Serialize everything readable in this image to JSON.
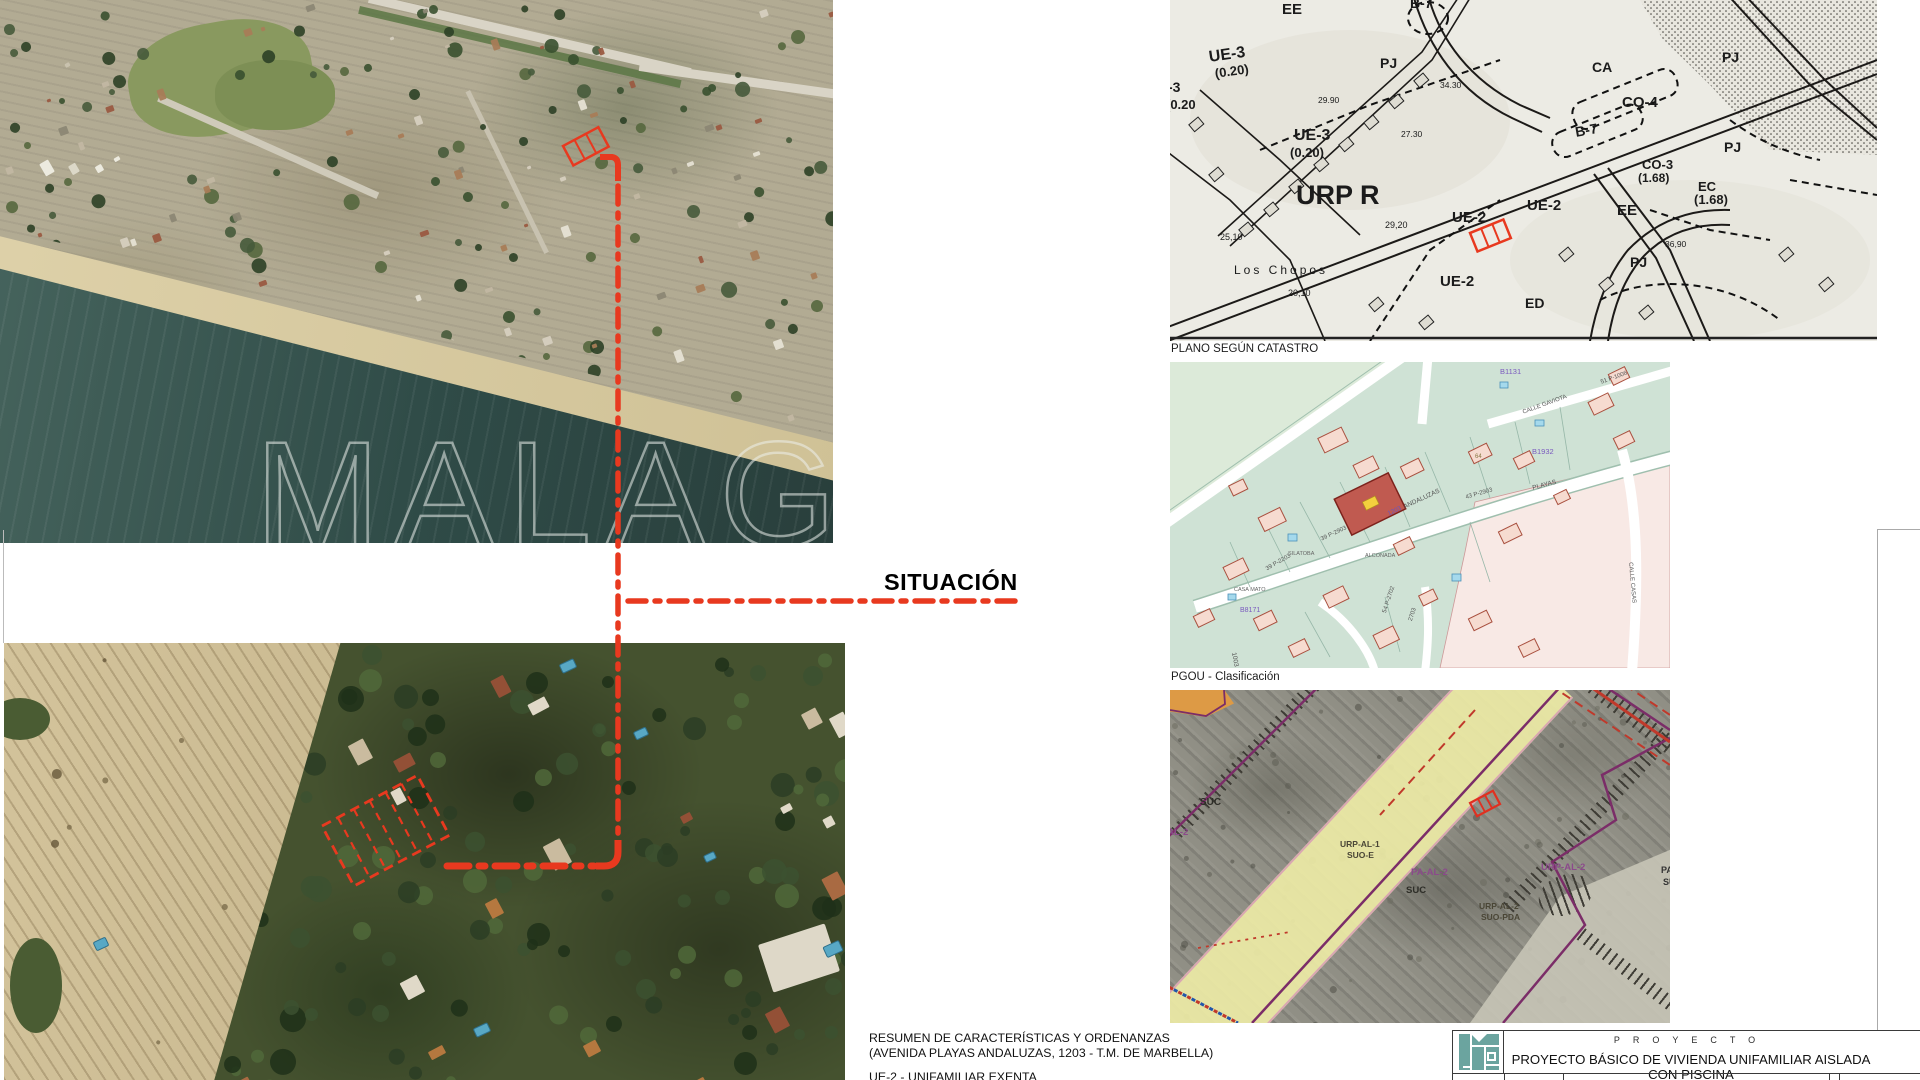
{
  "colors": {
    "accent_red": "#e8391f",
    "logo_teal": "#6ba49f"
  },
  "situacion_label": "SITUACIÓN",
  "watermark_text": "MALAGA",
  "captions": {
    "catastro": "PLANO SEGÚN CATASTRO",
    "pgou": "PGOU - Clasificación"
  },
  "summary": {
    "line1": "RESUMEN DE CARACTERÍSTICAS Y ORDENANZAS",
    "line2": "(AVENIDA PLAYAS ANDALUZAS, 1203 - T.M. DE MARBELLA)",
    "line3": "UE-2 - UNIFAMILIAR EXENTA"
  },
  "title_block": {
    "kicker": "PROYECTO",
    "title": "PROYECTO BÁSICO DE VIVIENDA UNIFAMILIAR AISLADA CON PISCINA"
  },
  "bw_map": {
    "labels": [
      {
        "t": "EE",
        "x": 112,
        "y": 2,
        "fs": 15,
        "b": 1
      },
      {
        "t": "B-7",
        "x": 240,
        "y": -4,
        "fs": 14,
        "b": 1
      },
      {
        "t": "PJ",
        "x": 210,
        "y": 56,
        "fs": 14,
        "b": 1
      },
      {
        "t": "UE-3",
        "x": 38,
        "y": 50,
        "fs": 16,
        "b": 1,
        "r": -8
      },
      {
        "t": "(0.20)",
        "x": 44,
        "y": 67,
        "fs": 13,
        "b": 1,
        "r": -8
      },
      {
        "t": "-3",
        "x": -2,
        "y": 80,
        "fs": 14,
        "b": 1
      },
      {
        "t": "(0.20",
        "x": -4,
        "y": 98,
        "fs": 13,
        "b": 1
      },
      {
        "t": "UE-3",
        "x": 124,
        "y": 128,
        "fs": 16,
        "b": 1
      },
      {
        "t": "(0.20)",
        "x": 120,
        "y": 146,
        "fs": 13,
        "b": 1
      },
      {
        "t": "29.90",
        "x": 148,
        "y": 96,
        "fs": 8.5
      },
      {
        "t": "34.30",
        "x": 270,
        "y": 81,
        "fs": 8.5
      },
      {
        "t": "27.30",
        "x": 231,
        "y": 130,
        "fs": 8.5
      },
      {
        "t": "URP R",
        "x": 126,
        "y": 182,
        "fs": 27,
        "b": 1
      },
      {
        "t": "25,10",
        "x": 50,
        "y": 233,
        "fs": 9
      },
      {
        "t": "29,20",
        "x": 215,
        "y": 221,
        "fs": 9
      },
      {
        "t": "Los Chopos",
        "x": 64,
        "y": 264,
        "fs": 12,
        "ls": 3
      },
      {
        "t": "20,10",
        "x": 118,
        "y": 289,
        "fs": 9
      },
      {
        "t": "UE-2",
        "x": 282,
        "y": 210,
        "fs": 15,
        "b": 1
      },
      {
        "t": "UE-2",
        "x": 357,
        "y": 198,
        "fs": 15,
        "b": 1
      },
      {
        "t": "UE-2",
        "x": 270,
        "y": 274,
        "fs": 15,
        "b": 1
      },
      {
        "t": "ED",
        "x": 355,
        "y": 296,
        "fs": 14,
        "b": 1
      },
      {
        "t": "CA",
        "x": 422,
        "y": 60,
        "fs": 14,
        "b": 1
      },
      {
        "t": "CO-4",
        "x": 452,
        "y": 95,
        "fs": 15,
        "b": 1
      },
      {
        "t": "B-7",
        "x": 404,
        "y": 125,
        "fs": 14,
        "b": 1,
        "r": -10
      },
      {
        "t": "PJ",
        "x": 552,
        "y": 50,
        "fs": 14,
        "b": 1
      },
      {
        "t": "PJ",
        "x": 554,
        "y": 140,
        "fs": 14,
        "b": 1
      },
      {
        "t": "CO-3",
        "x": 472,
        "y": 158,
        "fs": 13,
        "b": 1
      },
      {
        "t": "(1.68)",
        "x": 468,
        "y": 172,
        "fs": 12,
        "b": 1
      },
      {
        "t": "EC",
        "x": 528,
        "y": 180,
        "fs": 13,
        "b": 1
      },
      {
        "t": "(1.68)",
        "x": 524,
        "y": 193,
        "fs": 13,
        "b": 1
      },
      {
        "t": "EE",
        "x": 447,
        "y": 203,
        "fs": 15,
        "b": 1
      },
      {
        "t": "PJ",
        "x": 460,
        "y": 255,
        "fs": 14,
        "b": 1
      },
      {
        "t": "36,90",
        "x": 495,
        "y": 240,
        "fs": 8.5
      }
    ]
  },
  "parcel_map": {
    "labels": [
      {
        "t": "B1131",
        "x": 330,
        "y": 6,
        "fs": 7.5,
        "c": "#7a5abf"
      },
      {
        "t": "B1932",
        "x": 362,
        "y": 86,
        "fs": 7.5,
        "c": "#7a5abf"
      },
      {
        "t": "B8171",
        "x": 70,
        "y": 245,
        "fs": 7,
        "c": "#7a5abf"
      },
      {
        "t": "CALLE GAVIOTA",
        "x": 352,
        "y": 48,
        "fs": 6,
        "r": -20,
        "c": "#555"
      },
      {
        "t": "PLAYAS",
        "x": 362,
        "y": 124,
        "fs": 6.5,
        "r": -15,
        "c": "#555"
      },
      {
        "t": "43 P-2903",
        "x": 295,
        "y": 133,
        "fs": 6,
        "r": -16,
        "c": "#555"
      },
      {
        "t": "1203",
        "x": 217,
        "y": 150,
        "fs": 6.5,
        "r": -25,
        "c": "#6a55c0"
      },
      {
        "t": "ANDALUZAS",
        "x": 233,
        "y": 143,
        "fs": 6.5,
        "r": -25,
        "c": "#555"
      },
      {
        "t": "39 P-2903",
        "x": 150,
        "y": 175,
        "fs": 6,
        "r": -25,
        "c": "#555"
      },
      {
        "t": "39 P-2203",
        "x": 95,
        "y": 205,
        "fs": 6,
        "r": -30,
        "c": "#555"
      },
      {
        "t": "SILATOBA",
        "x": 118,
        "y": 190,
        "fs": 5.5,
        "c": "#666"
      },
      {
        "t": "ALCONADA",
        "x": 195,
        "y": 192,
        "fs": 5.5,
        "c": "#666"
      },
      {
        "t": "CASA MATO",
        "x": 64,
        "y": 226,
        "fs": 5.5,
        "c": "#666"
      },
      {
        "t": "64",
        "x": 305,
        "y": 92,
        "fs": 6,
        "c": "#887744"
      },
      {
        "t": "CALLE CASAS",
        "x": 463,
        "y": 200,
        "fs": 6,
        "r": 85,
        "c": "#555"
      },
      {
        "t": "54 P-2702",
        "x": 212,
        "y": 250,
        "fs": 6,
        "r": -72,
        "c": "#555"
      },
      {
        "t": "2703",
        "x": 238,
        "y": 258,
        "fs": 6,
        "r": -72,
        "c": "#555"
      },
      {
        "t": "1003",
        "x": 66,
        "y": 290,
        "fs": 6.5,
        "r": 80,
        "c": "#555"
      },
      {
        "t": "51 P-1006",
        "x": 430,
        "y": 18,
        "fs": 6,
        "r": -20,
        "c": "#555"
      }
    ]
  },
  "pgou_map": {
    "labels": [
      {
        "t": "SUC",
        "x": 30,
        "y": 108,
        "fs": 10,
        "b": 1,
        "c": "#2e2e28"
      },
      {
        "t": "URP-AL-1",
        "x": 170,
        "y": 150,
        "fs": 8.5,
        "b": 1,
        "c": "#4a4636"
      },
      {
        "t": "SUO-E",
        "x": 177,
        "y": 161,
        "fs": 8.5,
        "b": 1,
        "c": "#4a4636"
      },
      {
        "t": "PA-AL-2",
        "x": 241,
        "y": 178,
        "fs": 9.5,
        "b": 1,
        "c": "#8b4a8b"
      },
      {
        "t": "SUC",
        "x": 236,
        "y": 196,
        "fs": 9.5,
        "b": 1,
        "c": "#2e2e28"
      },
      {
        "t": "URP-AL-2",
        "x": 309,
        "y": 212,
        "fs": 8.5,
        "b": 1,
        "c": "#4a4636"
      },
      {
        "t": "SUO-PDA",
        "x": 311,
        "y": 223,
        "fs": 8.5,
        "b": 1,
        "c": "#4a4636"
      },
      {
        "t": "URP-AL-2",
        "x": 371,
        "y": 173,
        "fs": 9.5,
        "b": 1,
        "c": "#8b4a8b"
      },
      {
        "t": "-AL-2",
        "x": -6,
        "y": 138,
        "fs": 9.5,
        "b": 1,
        "c": "#8b4a8b"
      },
      {
        "t": "PA",
        "x": 491,
        "y": 176,
        "fs": 9,
        "b": 1,
        "c": "#333"
      },
      {
        "t": "SU",
        "x": 493,
        "y": 188,
        "fs": 9,
        "b": 1,
        "c": "#333"
      }
    ]
  }
}
